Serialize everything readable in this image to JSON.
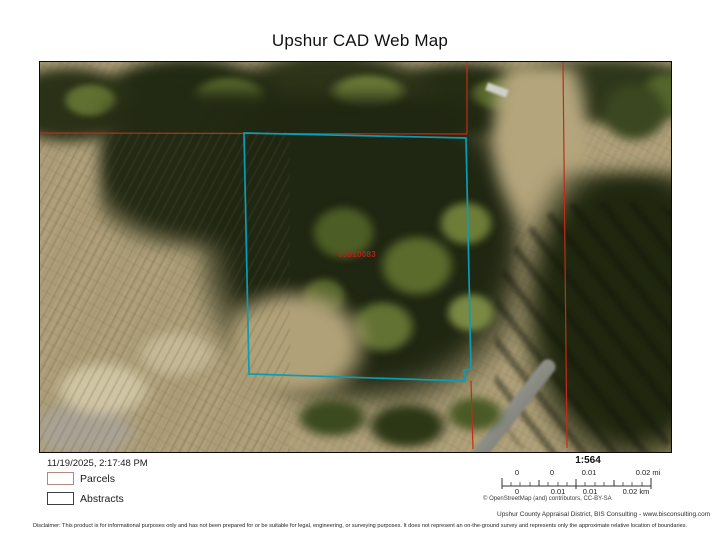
{
  "title": "Upshur CAD Web Map",
  "map": {
    "parcel_label": "05310083",
    "parcel_label_color": "#b2261c",
    "parcel_color": "#0b9db5",
    "boundary_color": "#c02d1a"
  },
  "footer": {
    "timestamp": "11/19/2025, 2:17:48 PM",
    "legend": [
      {
        "label": "Parcels",
        "swatch_color": "#b5867a"
      },
      {
        "label": "Abstracts",
        "swatch_color": "#3f3f3f"
      }
    ],
    "scale": {
      "ratio": "1:564",
      "mi_labels": [
        "0",
        "0",
        "0.01",
        "0.02 mi"
      ],
      "km_labels": [
        "0",
        "0.01",
        "0.01",
        "0.02 km"
      ]
    },
    "attribution": "© OpenStreetMap (and) contributors, CC-BY-SA",
    "credits": "Upshur County Appraisal District, BIS Consulting - www.bisconsulting.com",
    "disclaimer": "Disclaimer: This product is for informational purposes only and has not been prepared for or be suitable for legal, engineering, or surveying purposes. It does not represent an on-the-ground survey and represents only the approximate relative location of boundaries."
  }
}
